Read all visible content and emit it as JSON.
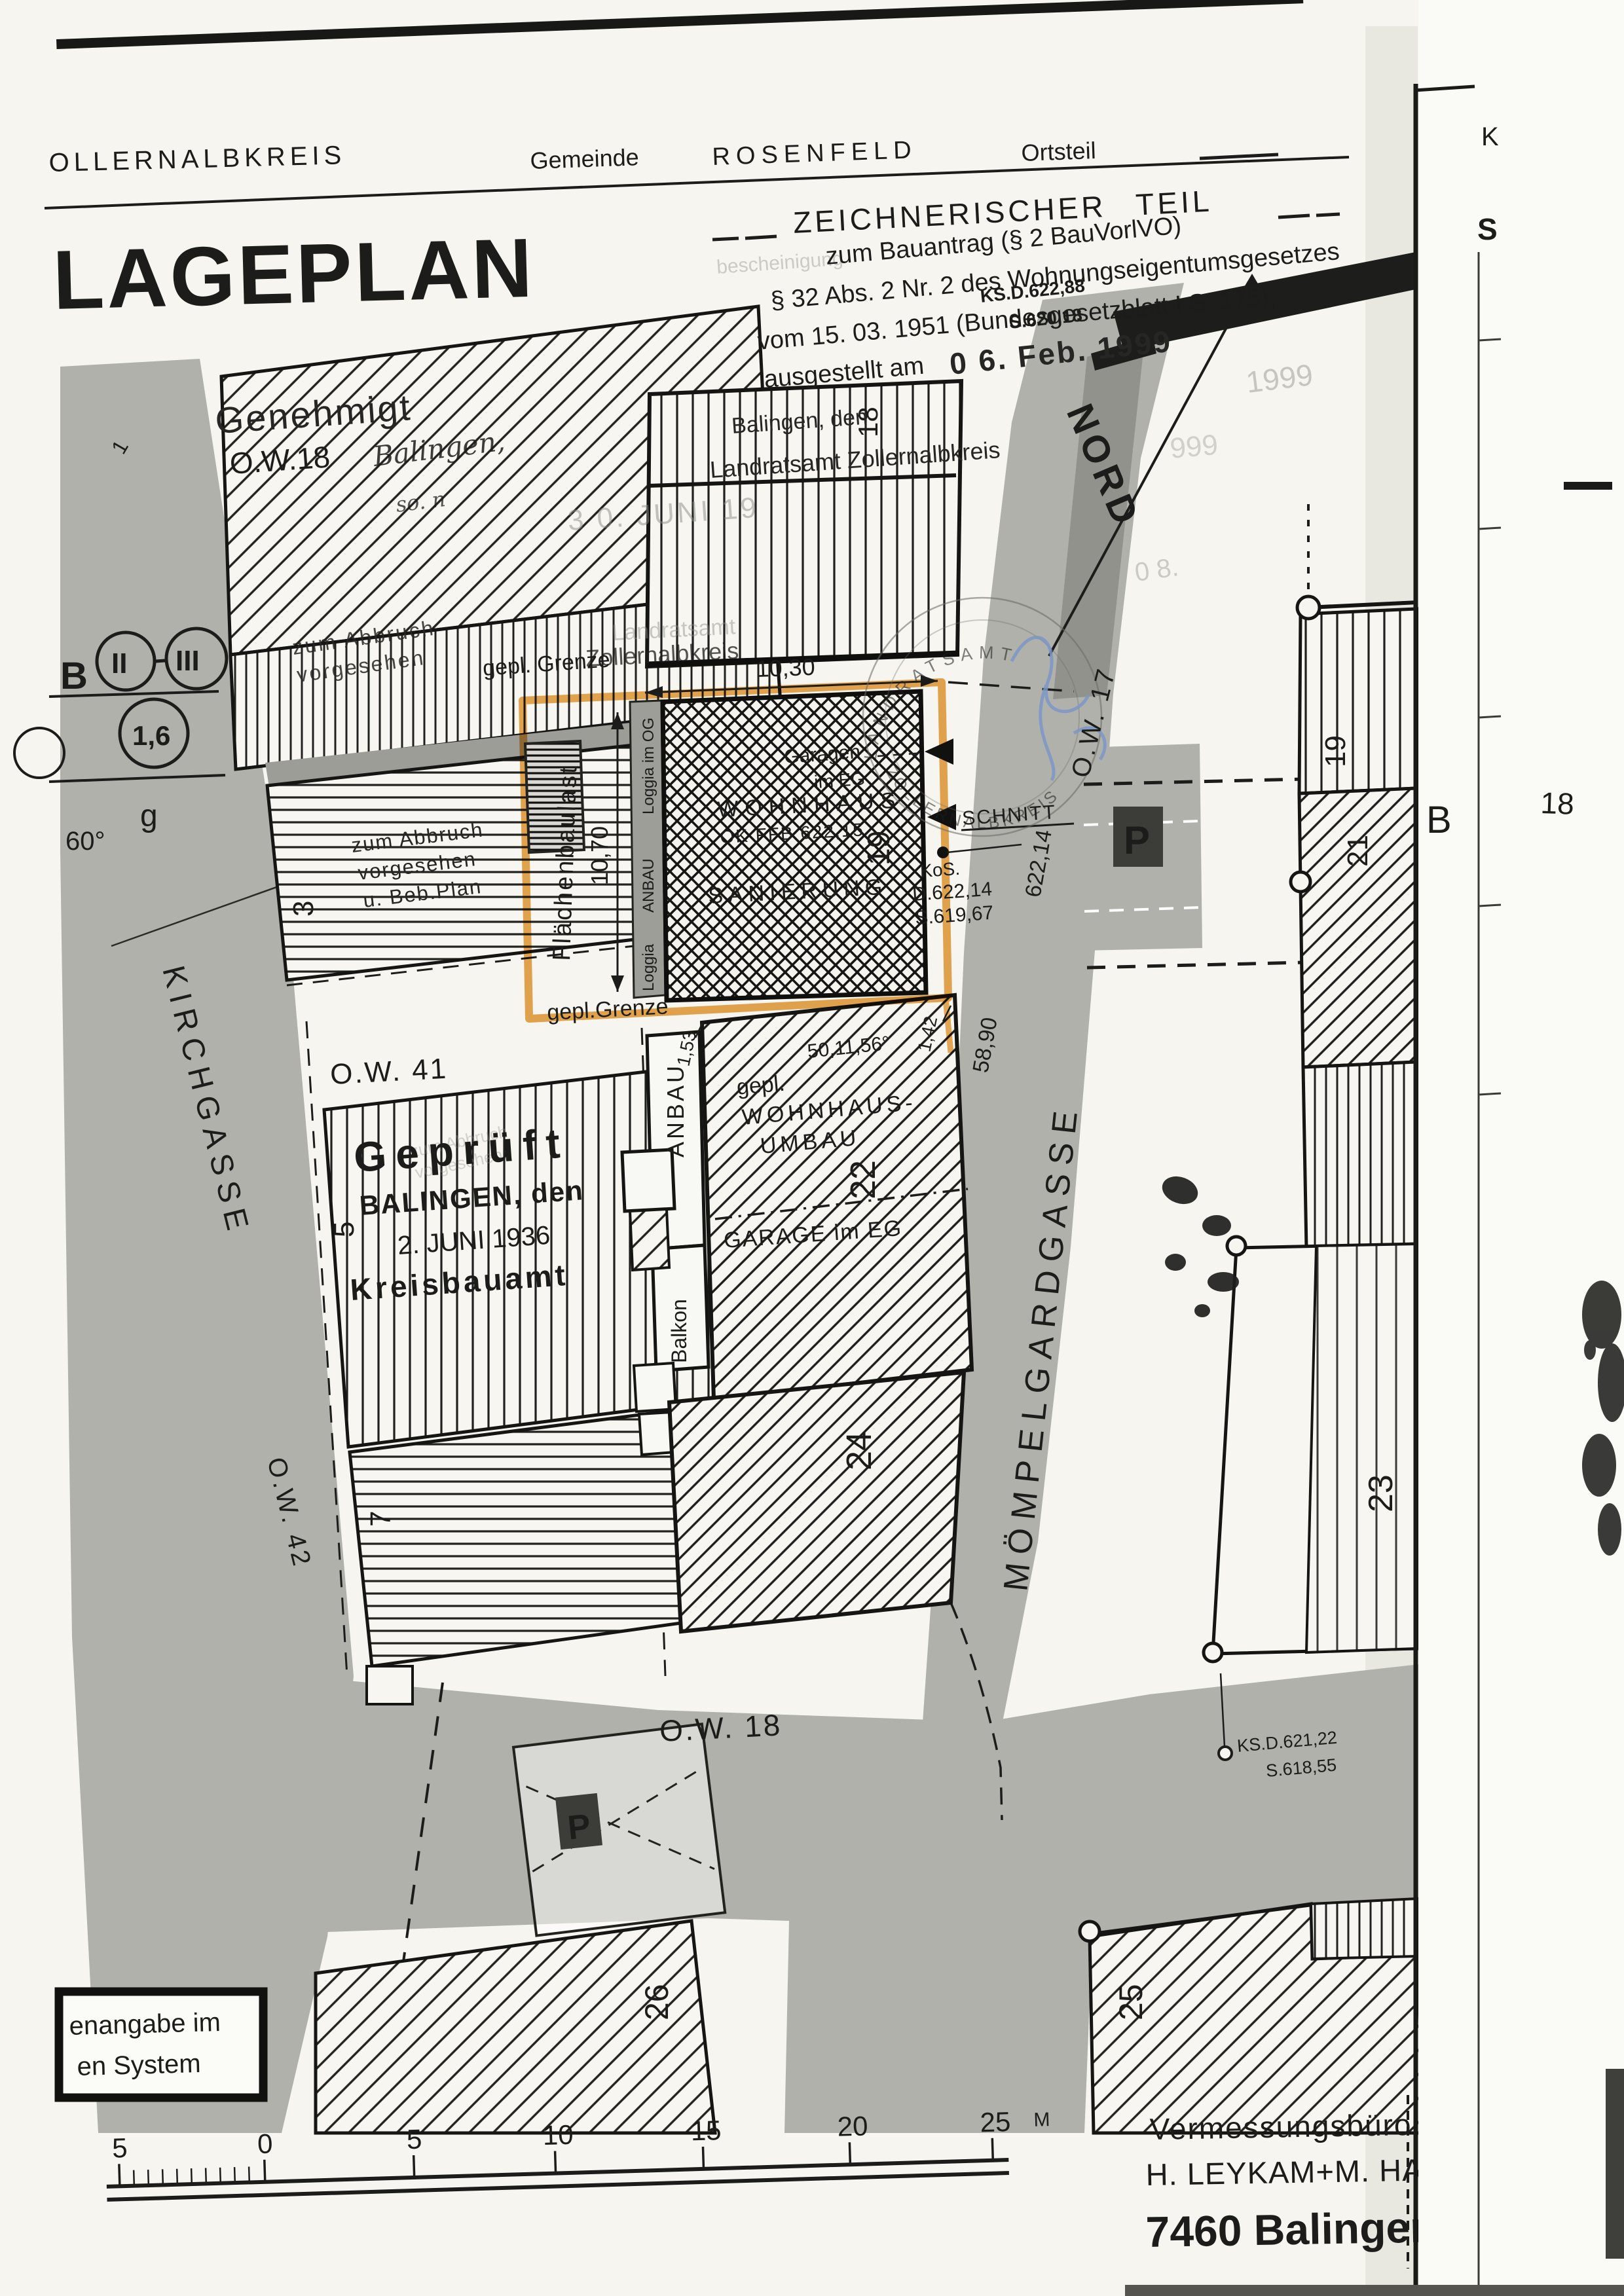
{
  "header": {
    "district": "OLLERNALBKREIS",
    "gemeinde_label": "Gemeinde",
    "gemeinde_value": "ROSENFELD",
    "ortsteil_label": "Ortsteil",
    "title": "LAGEPLAN",
    "subtitle": "ZEICHNERISCHER TEIL",
    "line1_faint": "bescheinigung",
    "line1": "zum Bauantrag (§ 2 BauVorlVO)",
    "line2": "§ 32 Abs. 2 Nr. 2 des Wohnungseigentumsgesetzes",
    "line3": "vom 15. 03. 1951 (Bundesgesetzblatt I S. 175),",
    "line4": "ausgestellt am",
    "date_stamp": "0 6. Feb. 1999",
    "date_echo1": "1999",
    "date_echo2": "999",
    "date_echo3": "0 8.",
    "overlay_ks": "KS.D.622,88",
    "overlay_s": "S.620,18"
  },
  "stamps": {
    "genehmigt": "Genehmigt",
    "ow18_top": "O.W.18",
    "balingen_script": "Balingen,",
    "so_n": "so. n",
    "balingen_den": "Balingen, den",
    "landratsamt": "Landratsamt Zollernalbkreis",
    "date_faint": "3 0. JUNI 19",
    "echo_landratsamt": "Landratsamt",
    "echo_zollernalbkreis": "Zollernalbkreis",
    "gepr_title": "Geprüft",
    "gepr_city": "BALINGEN, den",
    "gepr_date": "2. JUNI 1936",
    "gepr_office": "Kreisbauamt",
    "round_top": "LANDRATSAMT",
    "round_bottom": "ZOLLERNALBKREIS"
  },
  "legend": {
    "b": "B",
    "floors_a": "II",
    "floors_b": "III",
    "gfz": "1,6",
    "bauweise": "g",
    "angle": "60°"
  },
  "streets": {
    "kirchgasse": "KIRCHGASSE",
    "ow42": "O.W. 42",
    "ow41": "O.W. 41",
    "ow18": "O.W. 18",
    "ow17": "O.W. 17",
    "moempelgard": "MÖMPELGARDGASSE",
    "nord": "NORD"
  },
  "parcel": {
    "grenze_top": "gepl. Grenze",
    "grenze_bottom": "gepl.Grenze",
    "flaechenbaulast": "Flächenbaulast",
    "dim_w": "10,30",
    "dim_h": "10,70",
    "dim_153": "1,53",
    "dim_142": "1,42",
    "loggia_og": "Loggia im OG",
    "anbau_strip": "ANBAU",
    "loggia": "Loggia",
    "garagen": "Garagen",
    "im_eg": "im EG",
    "wohnhaus": "WOHNHAUS",
    "okffb": "OK FFB 622,15",
    "sanierung": "SANIERUNG"
  },
  "annotations": {
    "abbruch1a": "zum Abbruch",
    "abbruch1b": "vorgesehen",
    "abbruch2a": "zum Abbruch",
    "abbruch2b": "vorgesehen",
    "abbruch2c": "u. Beb.Plan",
    "schnitt": "SCHNITT",
    "kos": "KoS.",
    "kos_d": "D.622,14",
    "kos_s": "S.619,67",
    "ks": "KS.D.621,22",
    "ks_s": "S.618,55",
    "dim_622": "622,14",
    "dim_5890": "58,90",
    "angle_5011": "50,11,56°",
    "gepl": "gepl.",
    "wohnhaus_umbau": "WOHNHAUS-",
    "umbau": "UMBAU",
    "garage_eg": "GARAGE im EG",
    "anbau_col": "ANBAU",
    "balkon": "Balkon",
    "p": "P"
  },
  "parcels": {
    "n1": "1",
    "n3": "3",
    "n5": "5",
    "n7": "7",
    "n18_bldg": "18",
    "n19_haus": "19",
    "n19_east": "19",
    "n21": "21",
    "n22": "22",
    "n23": "23",
    "n24": "24",
    "n25": "25",
    "n26": "26"
  },
  "footer": {
    "note1": "enangabe im",
    "note2": "en System",
    "scale_ticks": [
      "5",
      "0",
      "5",
      "10",
      "15",
      "20",
      "25"
    ],
    "scale_unit": "M",
    "firm1": "Vermessungsbüro",
    "firm2": "H. LEYKAM+M. HAIGIS",
    "firm3": "7460 Balingen"
  },
  "side_sheet": {
    "k": "K",
    "s": "S",
    "b": "B",
    "n18": "18"
  },
  "colors": {
    "paper": "#f6f5f0",
    "street": "#b0b1aa",
    "highlight": "#e79f3e",
    "ink": "#1c1c1b",
    "blue": "#7b98c8"
  }
}
